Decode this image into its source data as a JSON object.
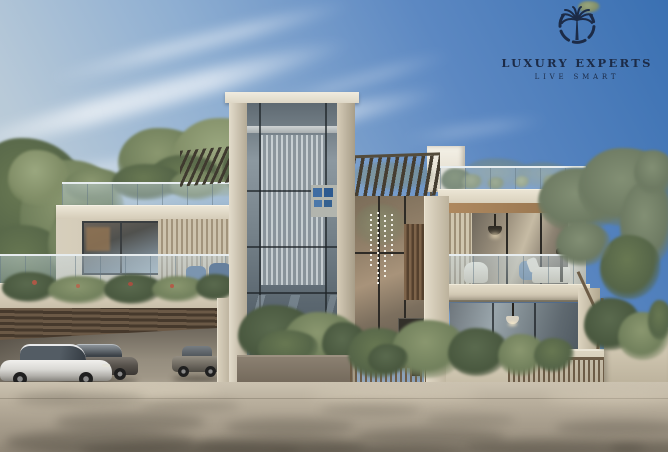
{
  "page": {
    "title": "Luxury villa exterior render"
  },
  "logo": {
    "brand": "LUXURY EXPERTS",
    "tagline": "LIVE SMART",
    "icon": "palm-in-crescent-icon",
    "color": "#1c2b47"
  },
  "signage": {
    "house_number": "66"
  },
  "palette": {
    "sky_deep": "#3a70b2",
    "sky_pale": "#ccd6da",
    "concrete_light": "#ece6d6",
    "concrete_mid": "#c4bba6",
    "wood_soffit": "#a8805a",
    "pergola_slat": "#453d30",
    "glass_reflective": "#8c98a0",
    "glass_interior_warm": "#a8937a",
    "foliage": "#71805c",
    "driveway": "#b8ae9c",
    "shadow": "#4a453b",
    "art_blue": "#3f6ca2"
  },
  "scene": {
    "vehicles": [
      "white sedan",
      "dark grey sedan",
      "grey sedan"
    ]
  }
}
